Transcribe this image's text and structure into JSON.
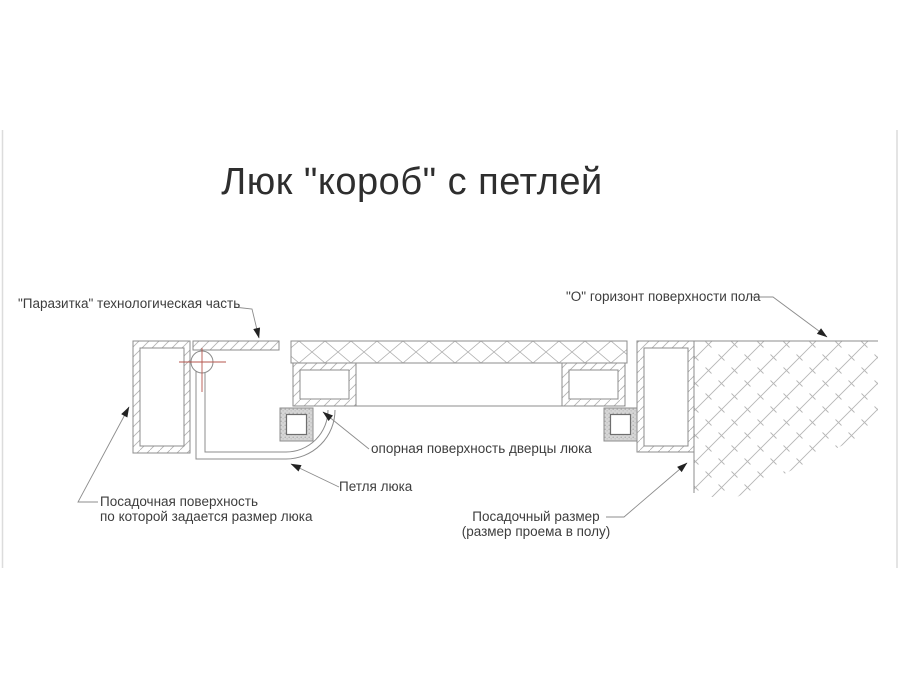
{
  "title": "Люк \"короб\" с петлей",
  "colors": {
    "line": "#8c8c8c",
    "hatch": "#b4b4b4",
    "text": "#3d3d3d",
    "centerline_red": "#b5544c",
    "arrow": "#222222"
  },
  "labels": {
    "parasitka": "\"Паразитка\" технологическая часть",
    "floor_horizon": "\"О\" горизонт поверхности пола",
    "door_support": "опорная поверхность дверцы люка",
    "hinge": "Петля люка",
    "seating_surface_line1": "Посадочная поверхность",
    "seating_surface_line2": "по которой задается размер люка",
    "seating_size_line1": "Посадочный размер",
    "seating_size_line2": "(размер проема в полу)"
  }
}
